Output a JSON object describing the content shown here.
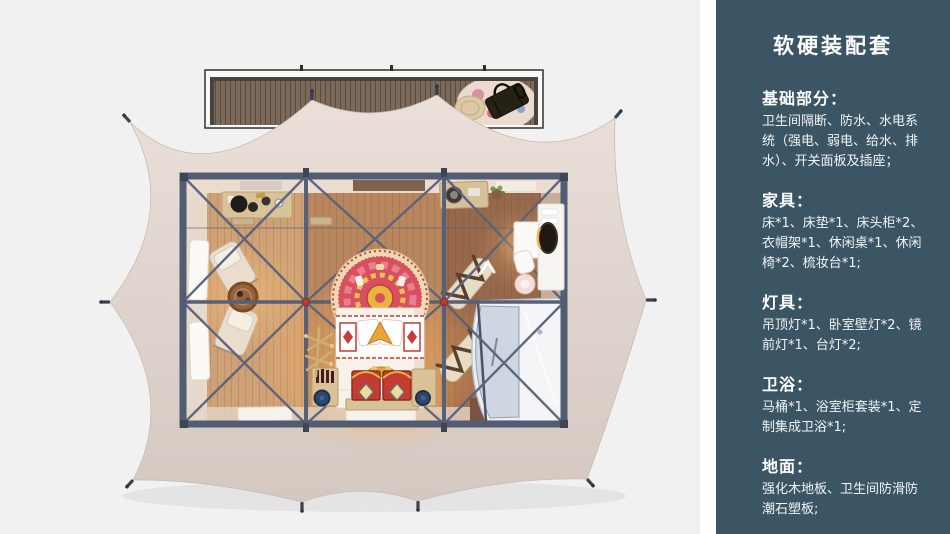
{
  "panel": {
    "title": "软硬装配套",
    "sections": [
      {
        "heading": "基础部分：",
        "body": "卫生间隔断、防水、水电系统（强电、弱电、给水、排水）、开关面板及插座；"
      },
      {
        "heading": "家具：",
        "body": "床*1、床垫*1、床头柜*2、衣帽架*1、休闲桌*1、休闲椅*2、梳妆台*1;"
      },
      {
        "heading": "灯具：",
        "body": "吊顶灯*1、卧室壁灯*2、镜前灯*1、台灯*2;"
      },
      {
        "heading": "卫浴：",
        "body": "马桶*1、浴室柜套装*1、定制集成卫浴*1;"
      },
      {
        "heading": "地面：",
        "body": "强化木地板、卫生间防滑防潮石塑板;"
      }
    ]
  },
  "colors": {
    "background": "#f1f1f2",
    "divider": "#ffffff",
    "panel_bg": "#3c5565",
    "panel_text": "#ffffff",
    "tent_canvas": "#ded3cc",
    "steel_frame": "#566077",
    "connector_red": "#c0392b",
    "wood_floor": "#b5835c",
    "deck_wood": "#7b695a",
    "glow_warm": "#f7a95c",
    "bed_red": "#d8505f",
    "pod_glass": "#c3cfdb"
  }
}
